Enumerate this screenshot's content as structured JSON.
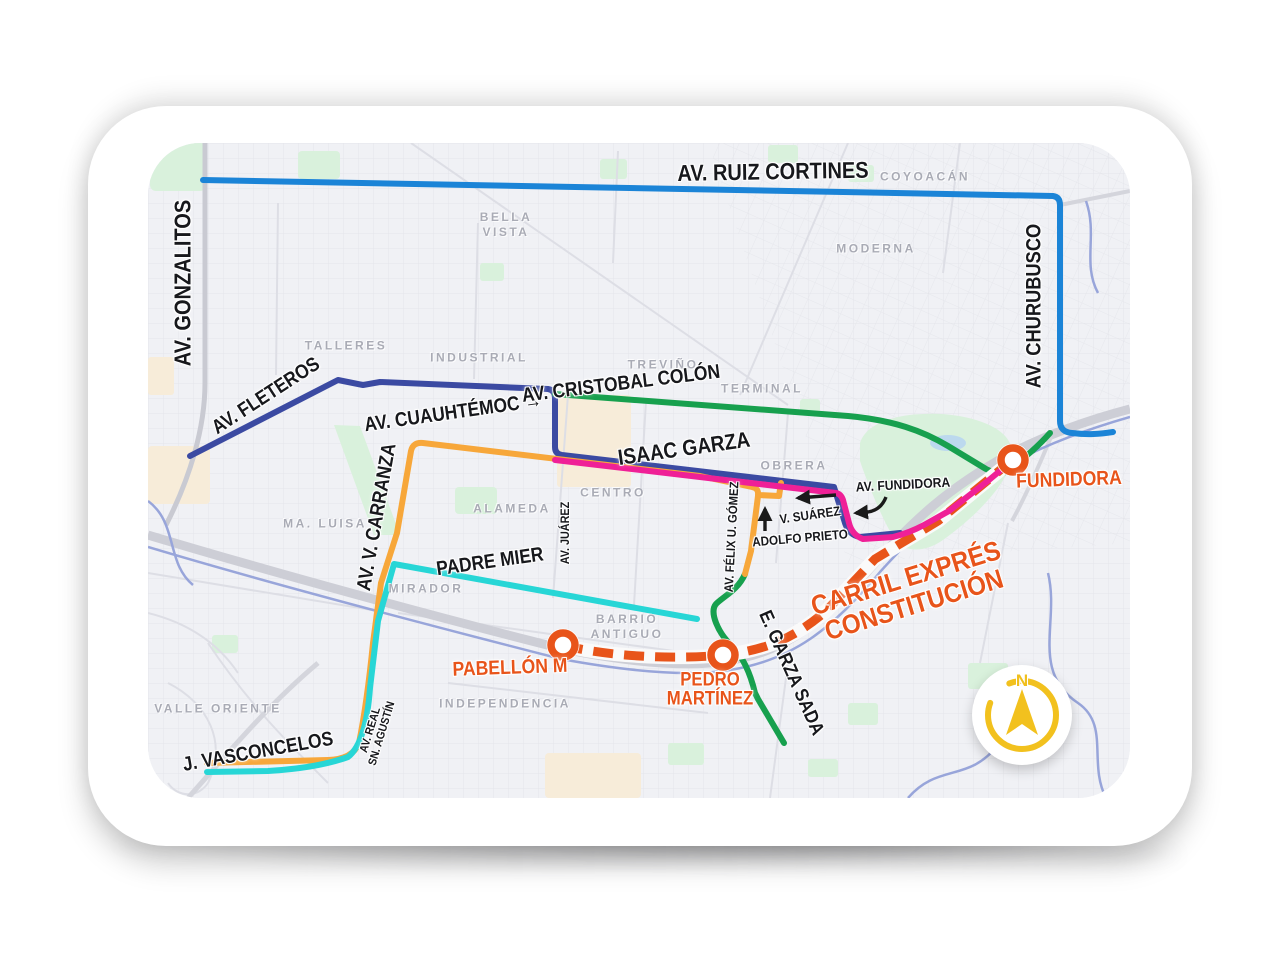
{
  "colors": {
    "ruiz_cortines_blue": "#1b84d7",
    "fleteros_navy": "#3b4aa2",
    "isaac_garza_magenta": "#ef2097",
    "cristobal_green": "#17a04e",
    "carranza_orange": "#f7a73a",
    "padre_mier_cyan": "#27d6d6",
    "express_orange": "#e8541a",
    "compass_yellow": "#f2c11e",
    "street_label_black": "#17181c",
    "area_label_gray": "#a9abb5",
    "highway_gray": "#cdced6",
    "river_blue": "#98a5da",
    "park_green": "#d9f1dc",
    "map_bg": "#f0f1f5"
  },
  "streets": {
    "ruiz_cortines": "AV. RUIZ CORTINES",
    "gonzalitos": "AV. GONZALITOS",
    "fleteros": "AV. FLETEROS",
    "cuauhtemoc": "AV. CUAUHTÉMOC →",
    "cristobal_colon": "AV. CRISTOBAL COLÓN",
    "isaac_garza": "ISAAC GARZA",
    "churubusco": "AV. CHURUBUSCO",
    "carranza": "AV. V. CARRANZA",
    "padre_mier": "PADRE MIER",
    "juarez": "AV. JUÁREZ",
    "felix_gomez": "AV. FÉLIX U. GÓMEZ",
    "adolfo_prieto": "ADOLFO PRIETO",
    "v_suarez": "V. SUÁREZ",
    "av_fundidora": "AV. FUNDIDORA",
    "vasconcelos": "J. VASCONCELOS",
    "real_agustin_1": "AV. REAL",
    "real_agustin_2": "SN. AGUSTÍN",
    "garza_sada": "E. GARZA SADA"
  },
  "express_lane": {
    "line1": "CARRIL EXPRÉS",
    "line2": "CONSTITUCIÓN"
  },
  "stations": {
    "fundidora": "FUNDIDORA",
    "pabellon_m": "PABELLÓN M",
    "pedro_martinez_1": "PEDRO",
    "pedro_martinez_2": "MARTÍNEZ"
  },
  "areas": {
    "bella_vista_1": "BELLA",
    "bella_vista_2": "VISTA",
    "coyoacan": "COYOACÁN",
    "moderna": "MODERNA",
    "talleres": "TALLERES",
    "industrial": "INDUSTRIAL",
    "trevino": "TREVIÑO",
    "terminal": "TERMINAL",
    "obrera": "OBRERA",
    "centro": "CENTRO",
    "alameda": "ALAMEDA",
    "ma_luisa": "MA. LUISA",
    "mirador": "MIRADOR",
    "barrio_antiguo_1": "BARRIO",
    "barrio_antiguo_2": "ANTIGUO",
    "independencia": "INDEPENDENCIA",
    "valle_oriente": "VALLE ORIENTE"
  },
  "compass": {
    "north": "N"
  }
}
